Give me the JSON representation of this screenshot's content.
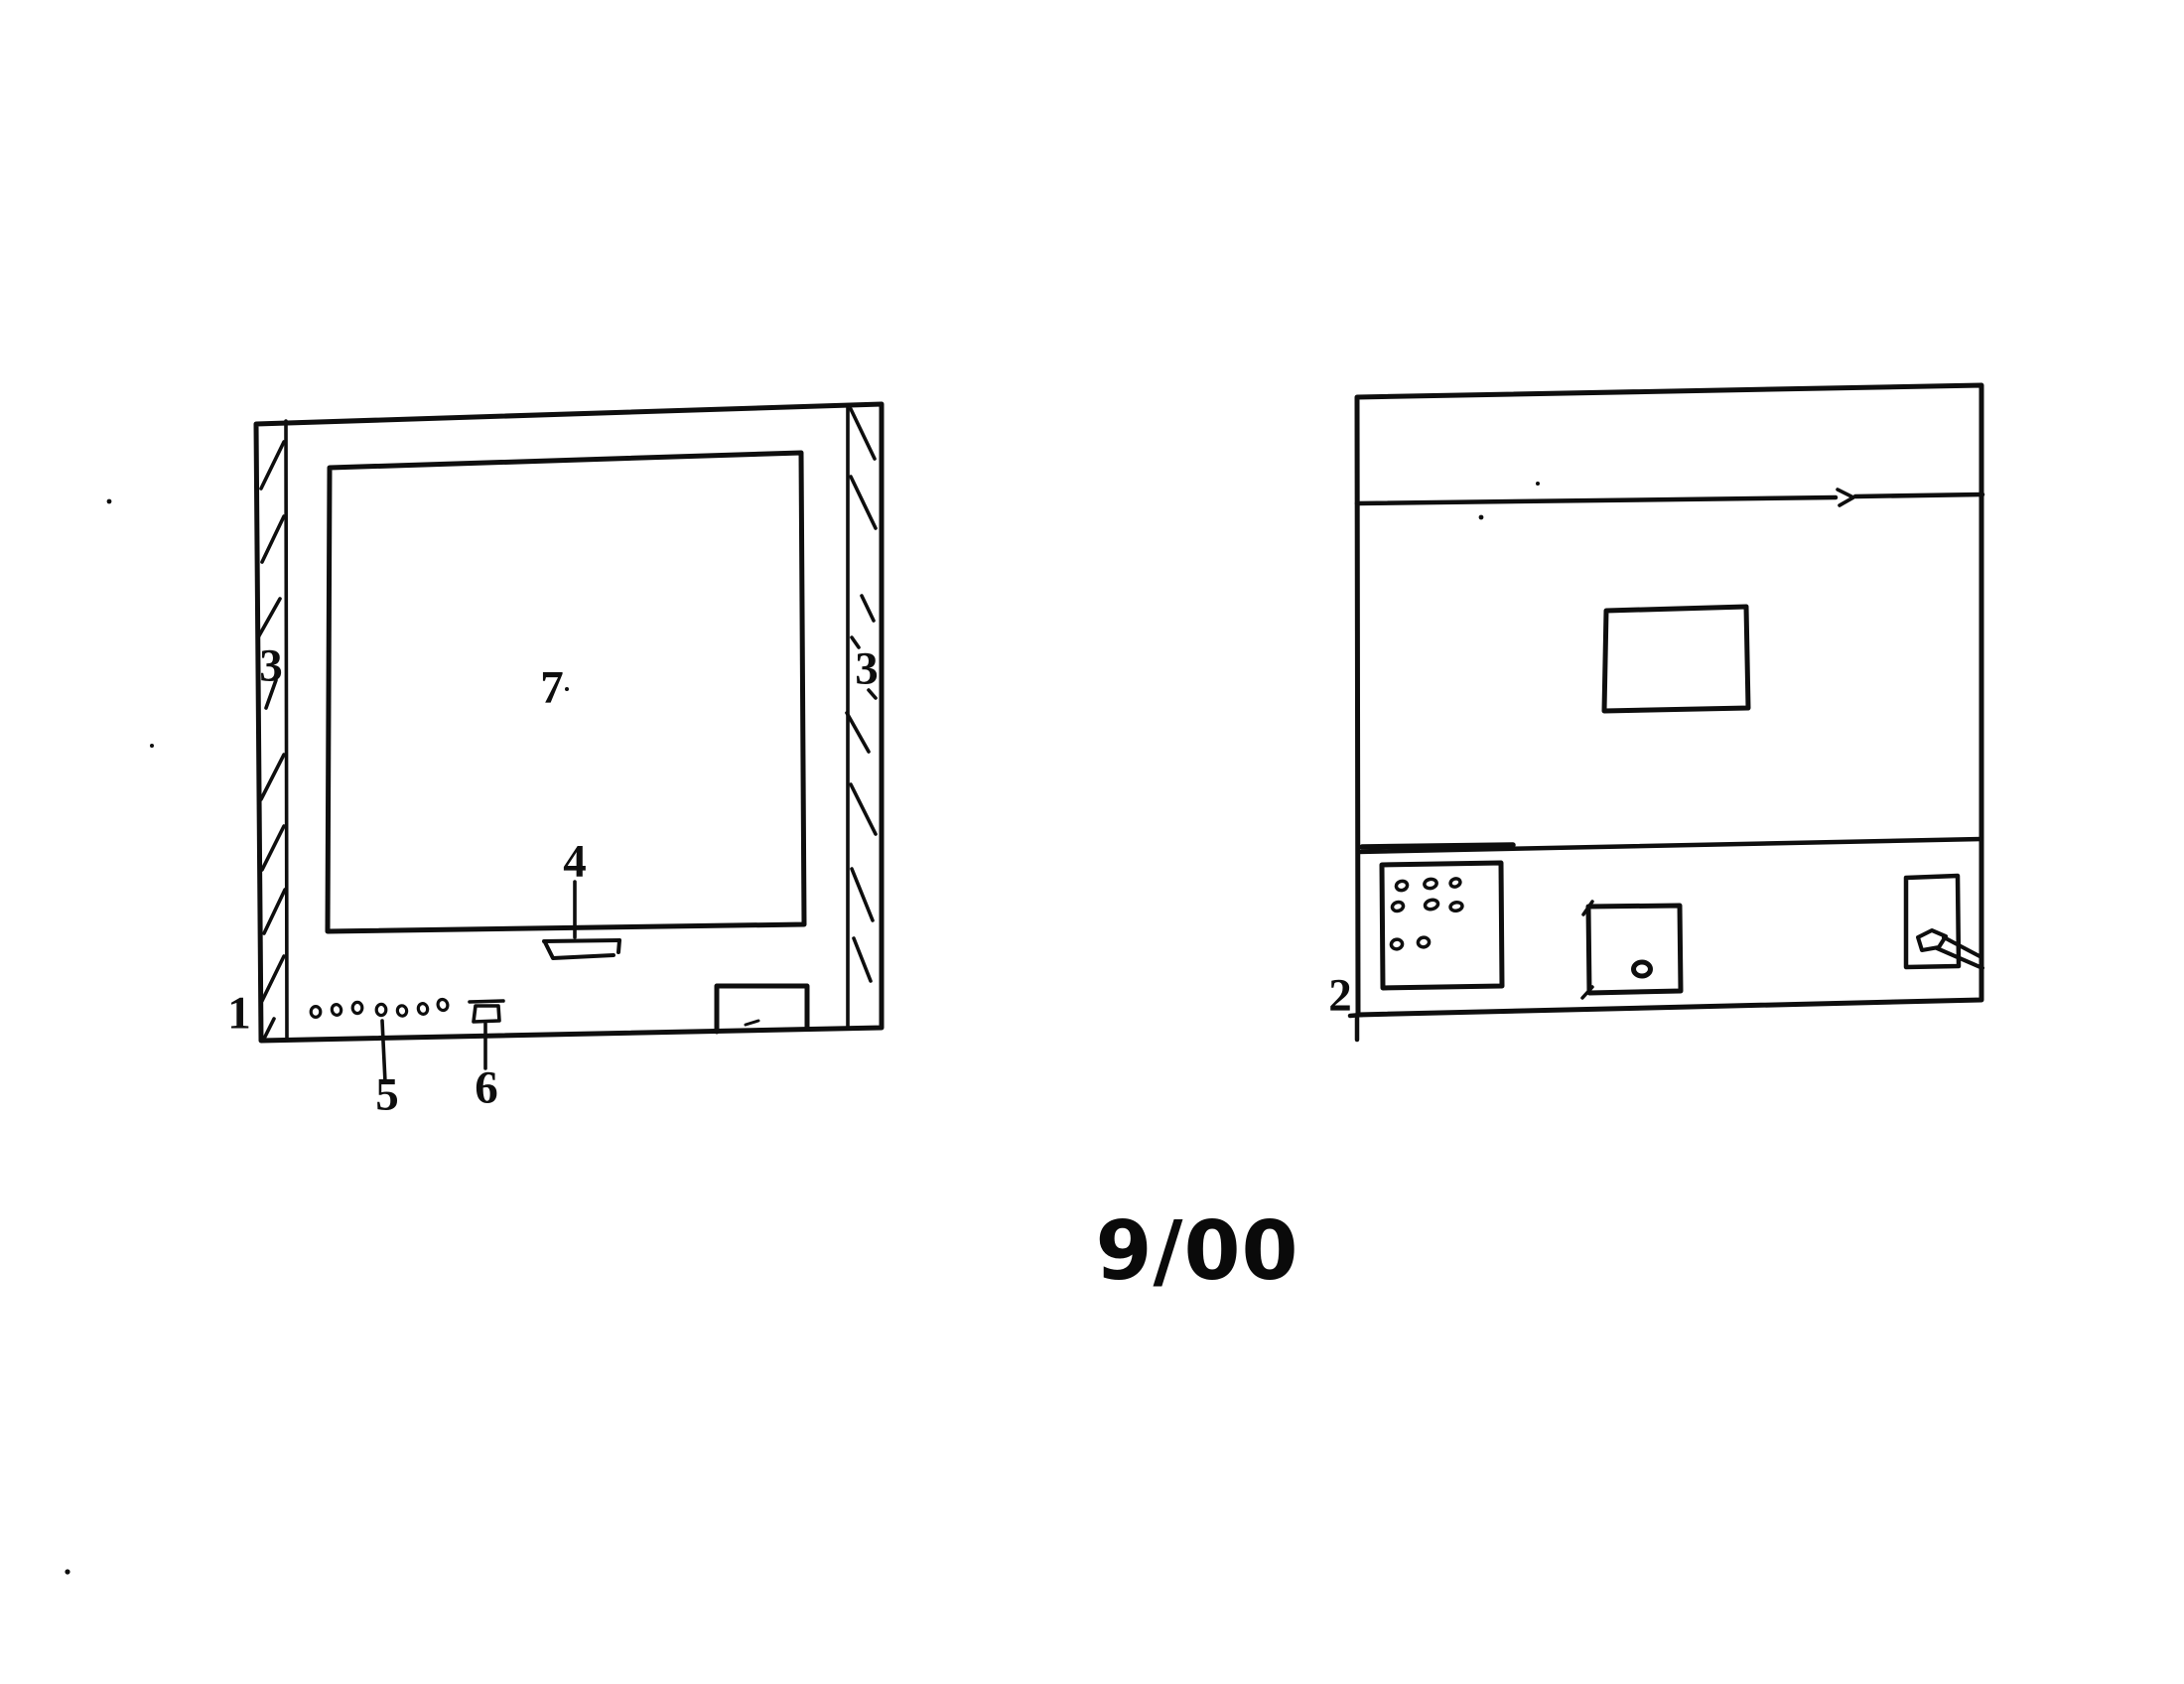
{
  "sheet": {
    "page_indicator": "9/00",
    "ink_color": "#0e0e0e",
    "paper_color": "#ffffff"
  },
  "figure1": {
    "ref_label": "1",
    "hatch_left_label": "3",
    "hatch_right_label": "3",
    "slot_label": "4",
    "led_row_label": "5",
    "connector_label": "6",
    "screen_label": "7"
  },
  "figure2": {
    "ref_label": "2"
  }
}
